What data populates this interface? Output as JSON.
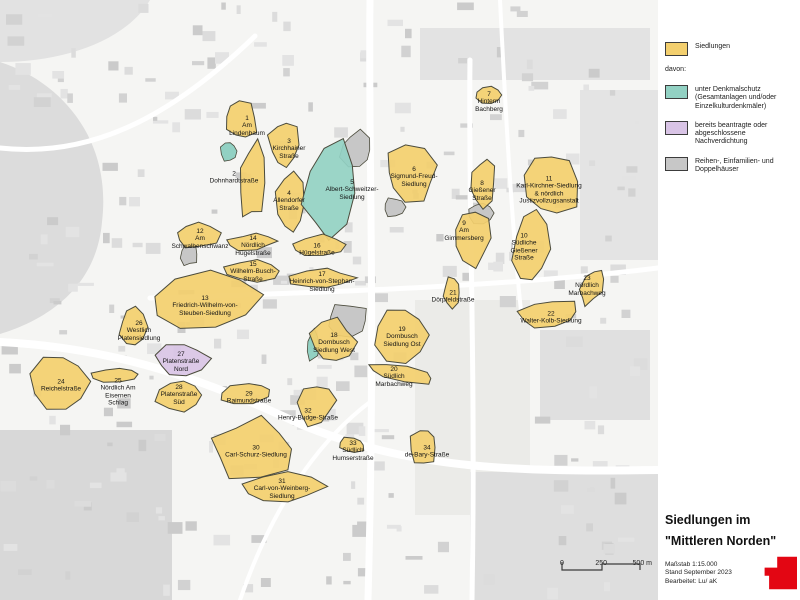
{
  "colors": {
    "siedlung": "#f3cf6e",
    "denkmal": "#92d1c3",
    "nachverdichtung": "#d9c4e6",
    "reihen": "#c7c7c7",
    "outline": "#4b4b3c",
    "accent_red": "#e30613"
  },
  "legend": {
    "siedlungen_label": "Siedlungen",
    "davon_label": "davon:",
    "sub_items": [
      {
        "label": "unter Denkmalschutz (Gesamtanlagen und/oder Einzelkulturdenkmäler)",
        "color": "#92d1c3"
      },
      {
        "label": "bereits beantragte oder abgeschlossene Nachverdichtung",
        "color": "#d9c4e6"
      },
      {
        "label": "Reihen-, Einfamilien- und Doppelhäuser",
        "color": "#c7c7c7"
      }
    ]
  },
  "title": {
    "line1": "Siedlungen im",
    "line2": "\"Mittleren Norden\""
  },
  "meta": {
    "scale": "Maßstab 1:15.000",
    "date": "Stand September 2023",
    "editor": "Bearbeitet: Lu/ aK"
  },
  "scalebar": {
    "t0": "0",
    "t250": "250",
    "t500": "500 m"
  },
  "settlements": [
    {
      "num": "1",
      "name": "Am Lindenbaum",
      "type": "siedlung",
      "x": 247,
      "y": 126
    },
    {
      "num": "2",
      "name": "Dohnhardtstraße",
      "type": "siedlung",
      "x": 234,
      "y": 178
    },
    {
      "num": "3",
      "name": "Kirchhainer Straße",
      "type": "siedlung",
      "x": 289,
      "y": 149
    },
    {
      "num": "4",
      "name": "Allendorfer Straße",
      "type": "siedlung",
      "x": 289,
      "y": 201
    },
    {
      "num": "5",
      "name": "Albert-Schweitzer-Siedlung",
      "type": "denkmal",
      "x": 352,
      "y": 190
    },
    {
      "num": "6",
      "name": "Sigmund-Freud-Siedlung",
      "type": "siedlung",
      "x": 414,
      "y": 177
    },
    {
      "num": "7",
      "name": "Hinterm Bachberg",
      "type": "siedlung",
      "x": 489,
      "y": 102
    },
    {
      "num": "8",
      "name": "Gießener Straße",
      "type": "siedlung",
      "x": 482,
      "y": 191
    },
    {
      "num": "9",
      "name": "Am Gimmersberg",
      "type": "siedlung",
      "x": 464,
      "y": 231
    },
    {
      "num": "10",
      "name": "Südliche Gießener Straße",
      "type": "siedlung",
      "x": 524,
      "y": 247
    },
    {
      "num": "11",
      "name": "Karl-Kirchner-Siedlung & nördlich Justizvollzugsanstalt",
      "type": "siedlung",
      "x": 549,
      "y": 190
    },
    {
      "num": "12",
      "name": "Am Schwalbenschwanz",
      "type": "siedlung",
      "x": 200,
      "y": 239
    },
    {
      "num": "13",
      "name": "Friedrich-Wilhelm-von-Steuben-Siedlung",
      "type": "siedlung",
      "x": 205,
      "y": 306
    },
    {
      "num": "14",
      "name": "Nördlich Hügelstraße",
      "type": "siedlung",
      "x": 253,
      "y": 246
    },
    {
      "num": "15",
      "name": "Wilhelm-Busch-Straße",
      "type": "siedlung",
      "x": 253,
      "y": 272
    },
    {
      "num": "16",
      "name": "Hügelstraße",
      "type": "siedlung",
      "x": 317,
      "y": 250
    },
    {
      "num": "17",
      "name": "Heinrich-von-Stephan-Siedlung",
      "type": "siedlung",
      "x": 322,
      "y": 282
    },
    {
      "num": "18",
      "name": "Dornbusch Siedlung West",
      "type": "siedlung",
      "x": 334,
      "y": 343
    },
    {
      "num": "19",
      "name": "Dornbusch Siedlung Ost",
      "type": "siedlung",
      "x": 402,
      "y": 337
    },
    {
      "num": "20",
      "name": "Südlich Marbachweg",
      "type": "siedlung",
      "x": 394,
      "y": 377
    },
    {
      "num": "21",
      "name": "Dörpfeldstraße",
      "type": "siedlung",
      "x": 453,
      "y": 297
    },
    {
      "num": "22",
      "name": "Walter-Kolb-Siedlung",
      "type": "siedlung",
      "x": 551,
      "y": 318
    },
    {
      "num": "23",
      "name": "Nördlich Marbachweg",
      "type": "siedlung",
      "x": 587,
      "y": 286
    },
    {
      "num": "24",
      "name": "Reichelstraße",
      "type": "siedlung",
      "x": 61,
      "y": 386
    },
    {
      "num": "25",
      "name": "Nördlich Am Eisernen Schlag",
      "type": "siedlung",
      "x": 118,
      "y": 392
    },
    {
      "num": "26",
      "name": "Westlich Platensiedlung",
      "type": "siedlung",
      "x": 139,
      "y": 331
    },
    {
      "num": "27",
      "name": "Platenstraße Nord",
      "type": "nachverdichtung",
      "x": 181,
      "y": 362
    },
    {
      "num": "28",
      "name": "Platenstraße Süd",
      "type": "siedlung",
      "x": 179,
      "y": 395
    },
    {
      "num": "29",
      "name": "Raimundstraße",
      "type": "siedlung",
      "x": 249,
      "y": 398
    },
    {
      "num": "30",
      "name": "Carl-Schurz-Siedlung",
      "type": "siedlung",
      "x": 256,
      "y": 452
    },
    {
      "num": "31",
      "name": "Carl-von-Weinberg-Siedlung",
      "type": "siedlung",
      "x": 282,
      "y": 489
    },
    {
      "num": "32",
      "name": "Henry-Budge-Straße",
      "type": "siedlung",
      "x": 308,
      "y": 415
    },
    {
      "num": "33",
      "name": "Südlich Humserstraße",
      "type": "siedlung",
      "x": 353,
      "y": 451
    },
    {
      "num": "34",
      "name": "de-Bary-Straße",
      "type": "siedlung",
      "x": 427,
      "y": 452
    }
  ]
}
